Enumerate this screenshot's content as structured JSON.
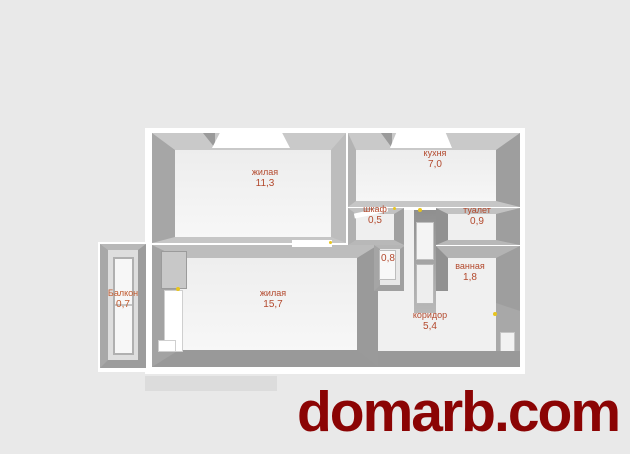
{
  "watermark": {
    "text": "domarb.com",
    "color": "#8b0404"
  },
  "palette": {
    "background": "#e9e9e9",
    "plan_frame": "#ffffff",
    "wall_light": "#c9c9c9",
    "wall_mid": "#b0b0b0",
    "wall_dark": "#999999",
    "floor": "#f5f5f5",
    "room_label": "#b3492d",
    "balcony_label": "#c05a2e",
    "handle_dot": "#e8c51e"
  },
  "floor_plan": {
    "rooms": [
      {
        "id": "living-1",
        "label": "жилая",
        "area": "11,3"
      },
      {
        "id": "kitchen",
        "label": "кухня",
        "area": "7,0"
      },
      {
        "id": "closet",
        "label": "шкаф",
        "area": "0,5"
      },
      {
        "id": "toilet",
        "label": "туалет",
        "area": "0,9"
      },
      {
        "id": "bath",
        "label": "ванная",
        "area": "1,8"
      },
      {
        "id": "niche",
        "label": "",
        "area": "0,8"
      },
      {
        "id": "living-2",
        "label": "жилая",
        "area": "15,7"
      },
      {
        "id": "corridor",
        "label": "коридор",
        "area": "5,4"
      },
      {
        "id": "balcony",
        "label": "Балкон",
        "area": "0,7"
      }
    ]
  }
}
